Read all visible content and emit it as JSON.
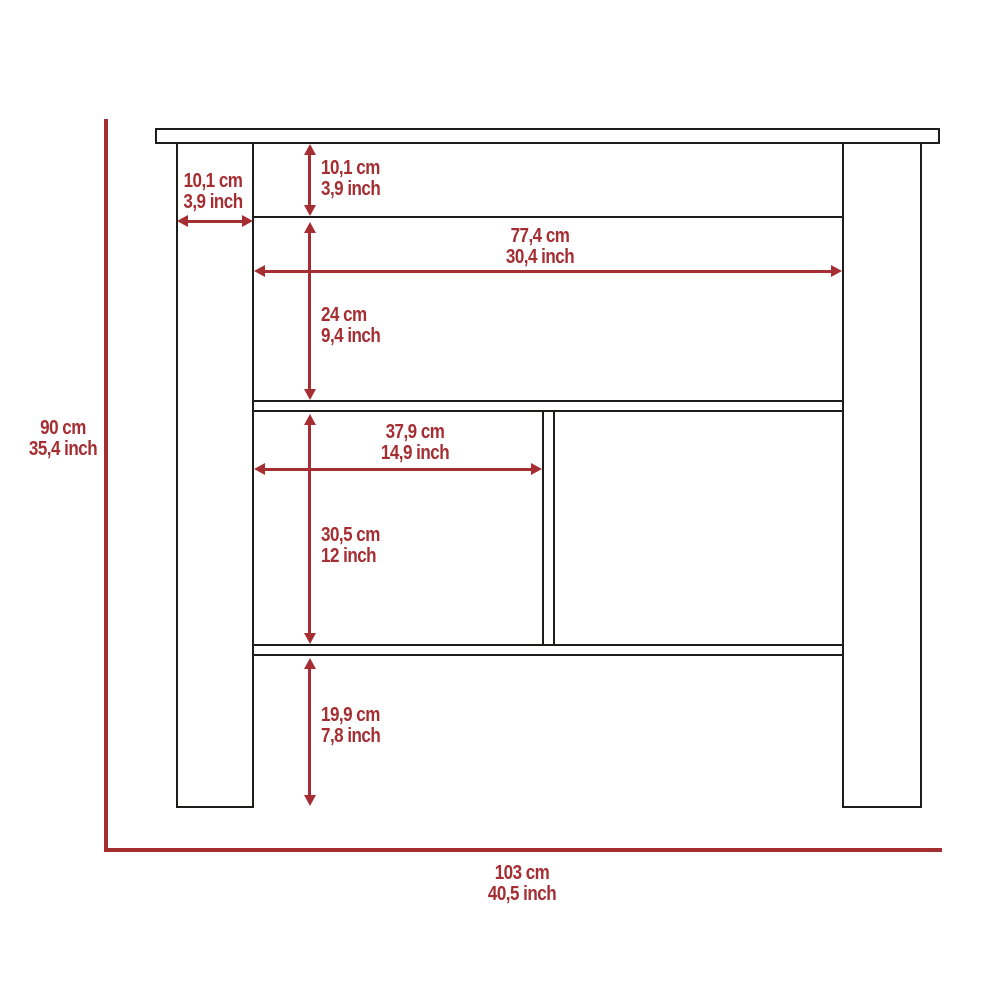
{
  "diagram_title": "kitchen-island-dimension-diagram",
  "colors": {
    "line": "#1d1d1b",
    "accent": "#a52e33",
    "background": "#ffffff"
  },
  "dimensions": {
    "leg_width": {
      "cm": "10,1 cm",
      "inch": "3,9 inch"
    },
    "top_shelf_height": {
      "cm": "10,1 cm",
      "inch": "3,9 inch"
    },
    "inner_width": {
      "cm": "77,4 cm",
      "inch": "30,4 inch"
    },
    "upper_compartment_height": {
      "cm": "24 cm",
      "inch": "9,4 inch"
    },
    "left_compartment_width": {
      "cm": "37,9 cm",
      "inch": "14,9 inch"
    },
    "middle_compartment_height": {
      "cm": "30,5 cm",
      "inch": "12 inch"
    },
    "bottom_clearance_height": {
      "cm": "19,9 cm",
      "inch": "7,8 inch"
    },
    "overall_height": {
      "cm": "90 cm",
      "inch": "35,4 inch"
    },
    "overall_width": {
      "cm": "103 cm",
      "inch": "40,5 inch"
    }
  }
}
